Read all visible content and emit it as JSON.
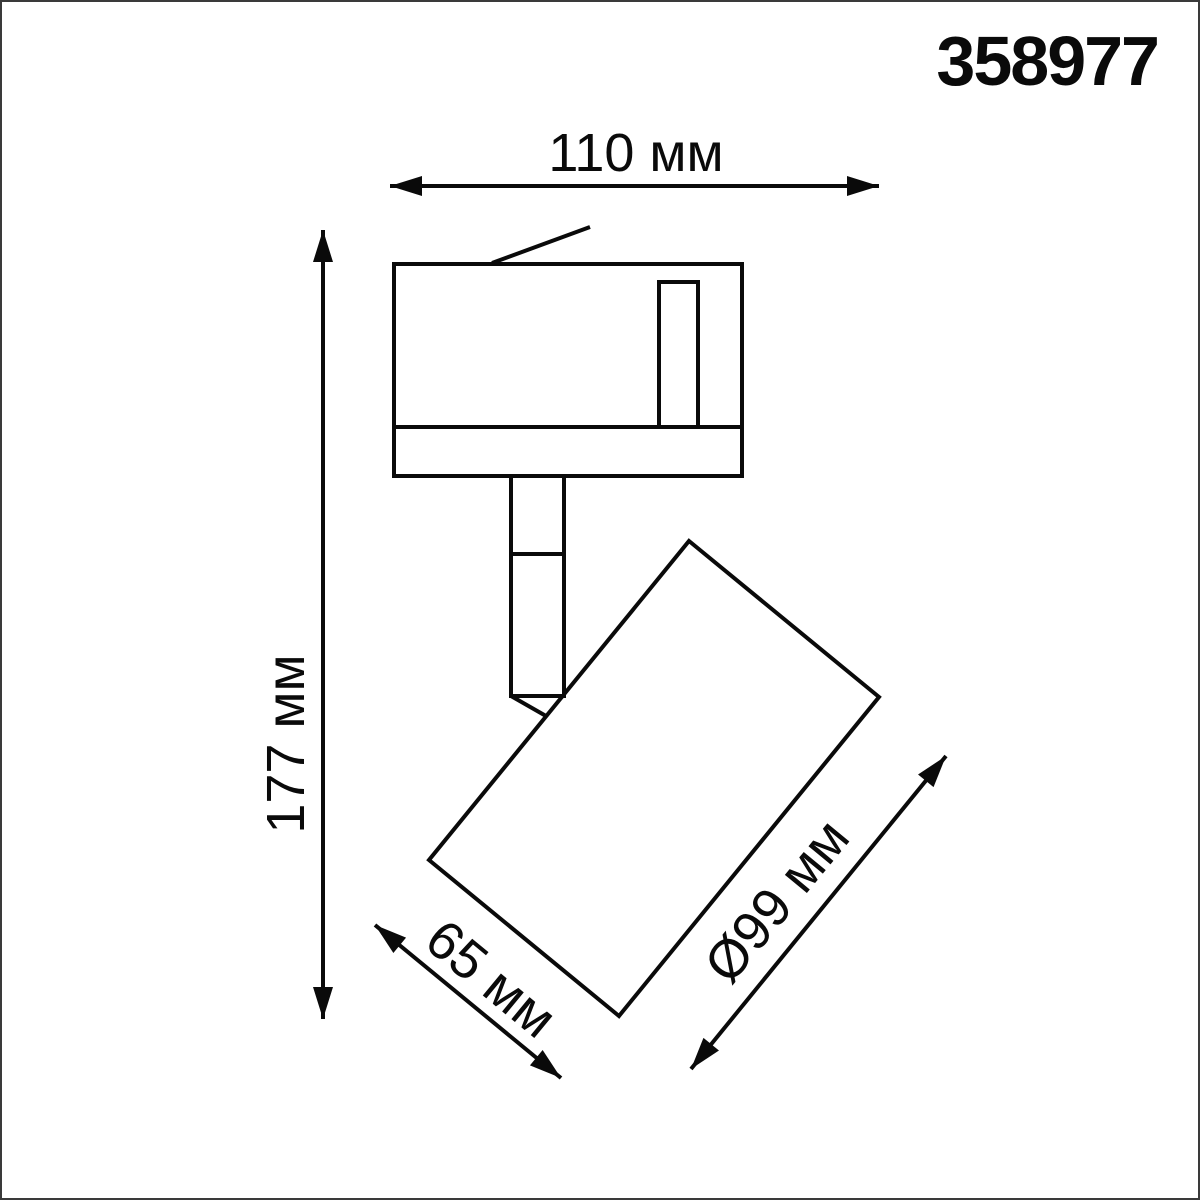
{
  "product_code": "358977",
  "dimensions": {
    "total_width_label": "110 мм",
    "total_height_label": "177 мм",
    "head_length_label": "65 мм",
    "head_diameter_label": "Ø99 мм"
  },
  "colors": {
    "line": "#0a0a0a",
    "background": "#ffffff",
    "frame": "#3a3a3a"
  }
}
